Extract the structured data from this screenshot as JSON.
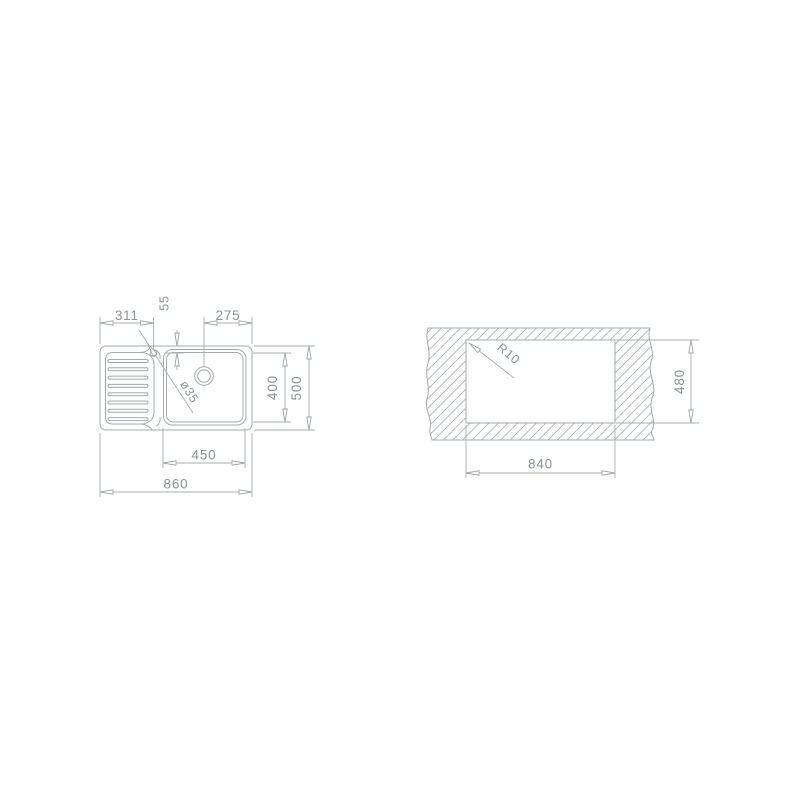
{
  "drawing_title": "Sink technical drawing",
  "colors": {
    "background": "#ffffff",
    "line": "#a6abaf",
    "hatch": "#aeb3b6",
    "dim_text": "#8d9499"
  },
  "sink_view": {
    "name": "sink top view",
    "dims": {
      "drainer_width": "311",
      "tap_hole_top_offset": "55",
      "tap_hole_from_right": "275",
      "bowl_depth": "400",
      "overall_depth": "500",
      "bowl_width": "450",
      "overall_width": "860",
      "tap_hole_diameter": "ø35"
    }
  },
  "cutout_view": {
    "name": "worktop cutout view",
    "dims": {
      "corner_radius": "R10",
      "cutout_height": "480",
      "cutout_width": "840"
    }
  }
}
